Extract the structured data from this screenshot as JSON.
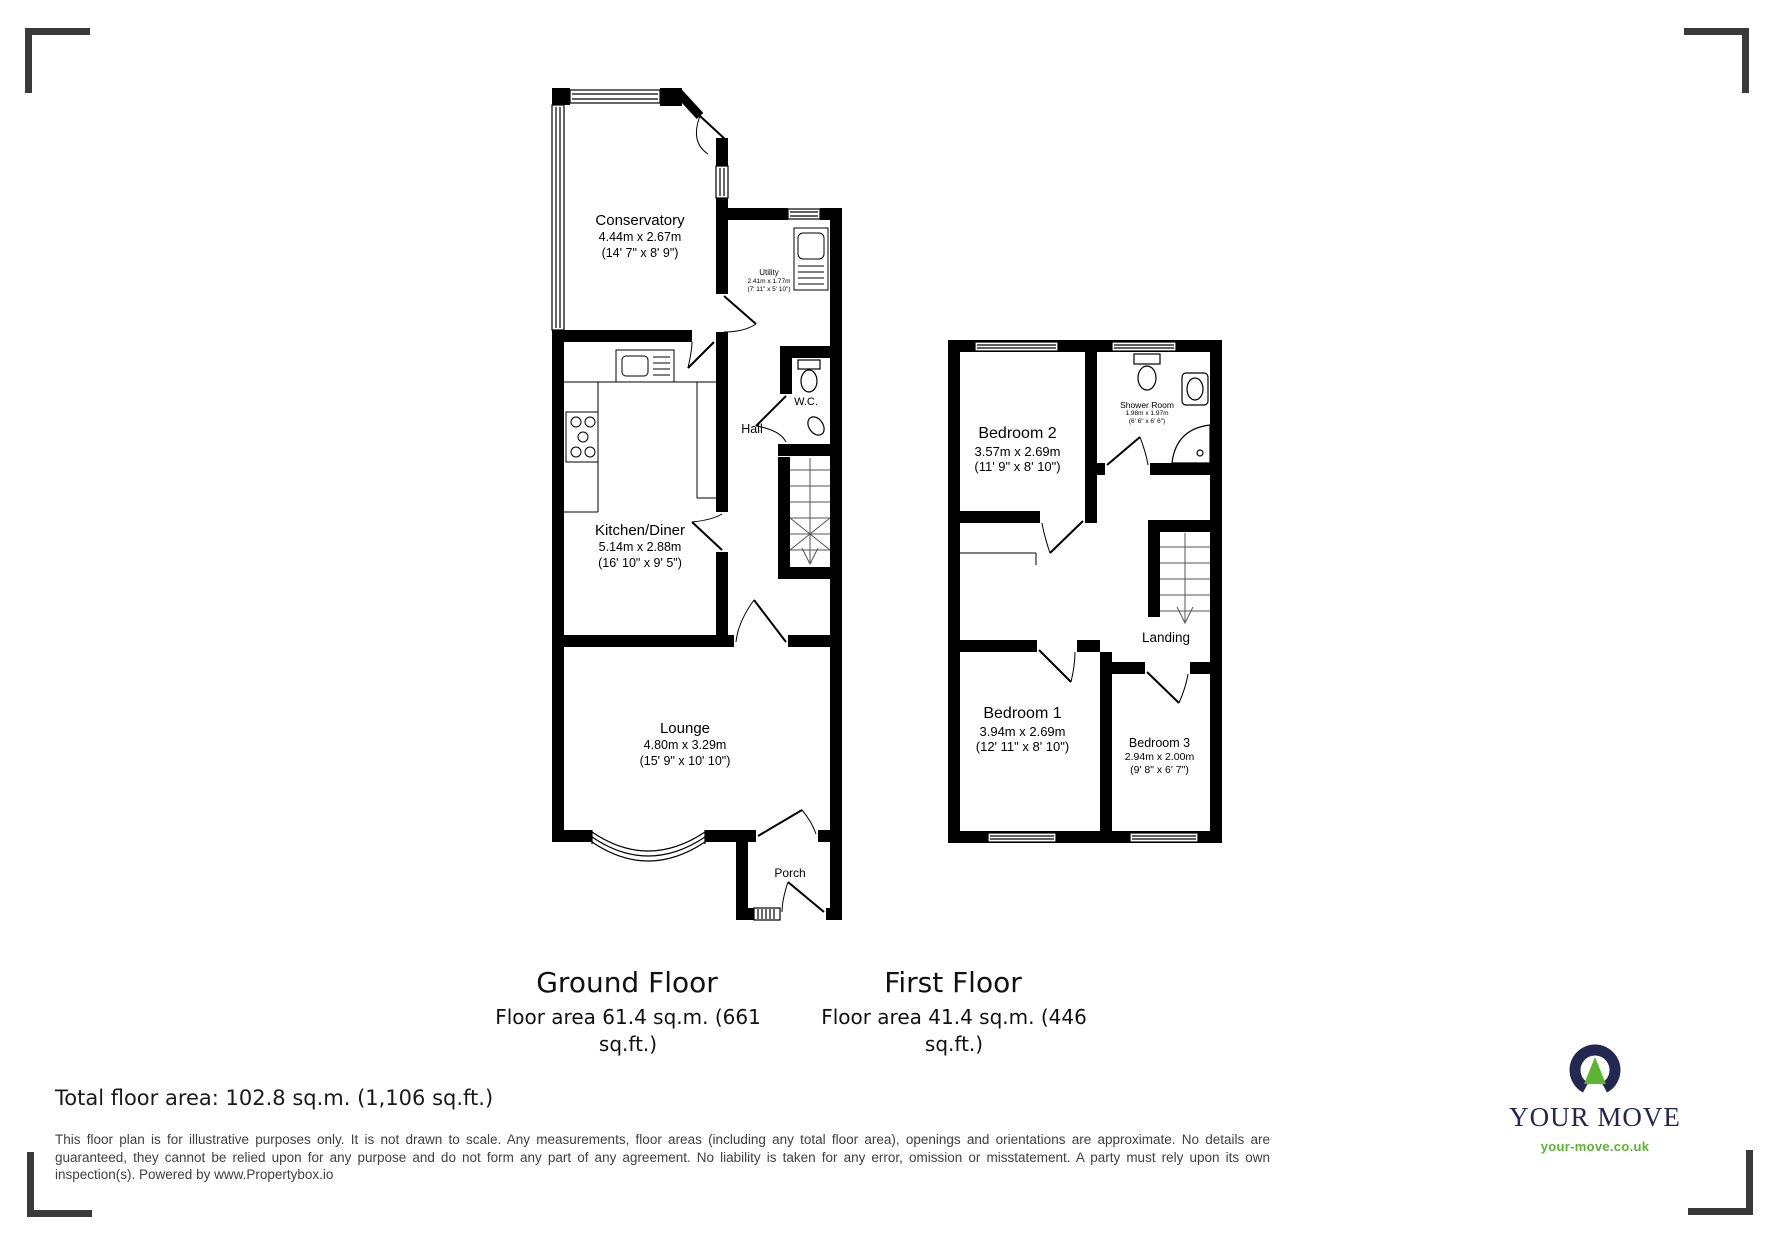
{
  "plan": {
    "ground": {
      "title": "Ground Floor",
      "area": "Floor area 61.4 sq.m. (661 sq.ft.)",
      "rooms": {
        "conservatory": {
          "name": "Conservatory",
          "metric": "4.44m x 2.67m",
          "imperial": "(14' 7\" x 8' 9\")"
        },
        "utility": {
          "name": "Utility",
          "metric": "2.41m x 1.77m",
          "imperial": "(7' 11\" x 5' 10\")"
        },
        "wc": {
          "name": "W.C."
        },
        "hall": {
          "name": "Hall"
        },
        "kitchen_diner": {
          "name": "Kitchen/Diner",
          "metric": "5.14m x 2.88m",
          "imperial": "(16' 10\" x 9' 5\")"
        },
        "lounge": {
          "name": "Lounge",
          "metric": "4.80m x 3.29m",
          "imperial": "(15' 9\" x 10' 10\")"
        },
        "porch": {
          "name": "Porch"
        }
      }
    },
    "first": {
      "title": "First Floor",
      "area": "Floor area 41.4 sq.m. (446 sq.ft.)",
      "rooms": {
        "bedroom2": {
          "name": "Bedroom 2",
          "metric": "3.57m x 2.69m",
          "imperial": "(11' 9\" x 8' 10\")"
        },
        "shower_room": {
          "name": "Shower Room",
          "metric": "1.98m x 1.97m",
          "imperial": "(6' 6\" x 6' 6\")"
        },
        "landing": {
          "name": "Landing"
        },
        "bedroom1": {
          "name": "Bedroom 1",
          "metric": "3.94m x 2.69m",
          "imperial": "(12' 11\" x 8' 10\")"
        },
        "bedroom3": {
          "name": "Bedroom 3",
          "metric": "2.94m x 2.00m",
          "imperial": "(9' 8\" x 6' 7\")"
        }
      }
    },
    "total_area": "Total floor area: 102.8 sq.m. (1,106 sq.ft.)",
    "disclaimer": "This floor plan is for illustrative purposes only. It is not drawn to scale. Any measurements, floor areas (including any total floor area), openings and orientations are approximate. No details are guaranteed, they cannot be relied upon for any purpose and do not form any part of any agreement. No liability is taken for any error, omission or misstatement. A party must rely upon its own inspection(s). Powered by www.Propertybox.io"
  },
  "branding": {
    "name": "YOUR MOVE",
    "website": "your-move.co.uk",
    "navy": "#232850",
    "green": "#5cb531",
    "wall_color": "#000000",
    "corner_mark_color": "#3a3a3a"
  }
}
